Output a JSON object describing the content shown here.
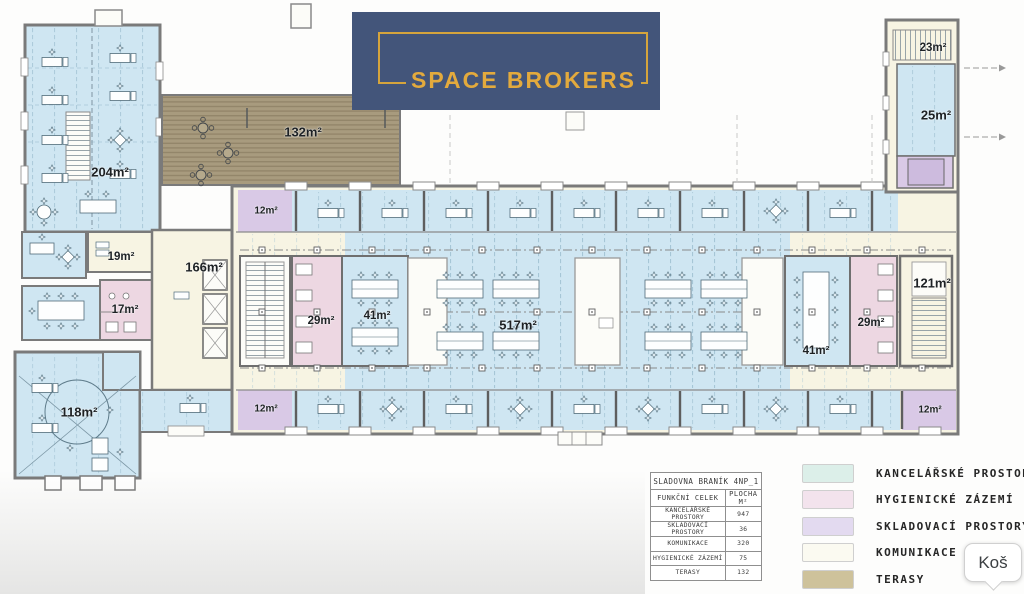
{
  "logo": {
    "text": "SPACE BROKERS",
    "background": "#43557a",
    "accent": "#dfa43e"
  },
  "tooltip": {
    "text": "Koš"
  },
  "legend": {
    "items": [
      {
        "label": "KANCELÁŘSKÉ PROSTORY",
        "color": "#dcefe9"
      },
      {
        "label": "HYGIENICKÉ ZÁZEMÍ",
        "color": "#f3e3ed"
      },
      {
        "label": "SKLADOVACÍ PROSTORY",
        "color": "#e3daf0"
      },
      {
        "label": "KOMUNIKACE",
        "color": "#fbfaf1"
      },
      {
        "label": "TERASY",
        "color": "#cec29b"
      }
    ]
  },
  "area_table": {
    "title": "SLADOVNA BRANÍK 4NP_1",
    "columns": [
      "FUNKČNÍ CELEK",
      "PLOCHA M²"
    ],
    "rows": [
      [
        "KANCELÁŘSKÉ PROSTORY",
        "947"
      ],
      [
        "SKLADOVACÍ PROSTORY",
        "36"
      ],
      [
        "KOMUNIKACE",
        "320"
      ],
      [
        "HYGIENICKÉ ZÁZEMÍ",
        "75"
      ],
      [
        "TERASY",
        "132"
      ]
    ]
  },
  "rooms": [
    {
      "id": "office-204",
      "label": "204m²"
    },
    {
      "id": "terrace-132",
      "label": "132m²"
    },
    {
      "id": "circulation-19",
      "label": "19m²"
    },
    {
      "id": "circulation-166",
      "label": "166m²"
    },
    {
      "id": "hygiene-17",
      "label": "17m²"
    },
    {
      "id": "office-118",
      "label": "118m²"
    },
    {
      "id": "storage-12-top-left",
      "label": "12m²"
    },
    {
      "id": "storage-12-bot-left",
      "label": "12m²"
    },
    {
      "id": "hygiene-29-left",
      "label": "29m²"
    },
    {
      "id": "office-41-left",
      "label": "41m²"
    },
    {
      "id": "office-517",
      "label": "517m²"
    },
    {
      "id": "office-41-right",
      "label": "41m²"
    },
    {
      "id": "hygiene-29-right",
      "label": "29m²"
    },
    {
      "id": "circulation-121",
      "label": "121m²"
    },
    {
      "id": "storage-12-bot-right",
      "label": "12m²"
    },
    {
      "id": "office-25",
      "label": "25m²"
    },
    {
      "id": "circulation-23",
      "label": "23m²"
    }
  ],
  "plan_colors": {
    "office": "#cfe6f2",
    "hygiene": "#edd7e2",
    "storage": "#d9c9e6",
    "circulation": "#f7f4e3",
    "terrace": "#a89b7e",
    "wall": "#7a7a7a"
  }
}
